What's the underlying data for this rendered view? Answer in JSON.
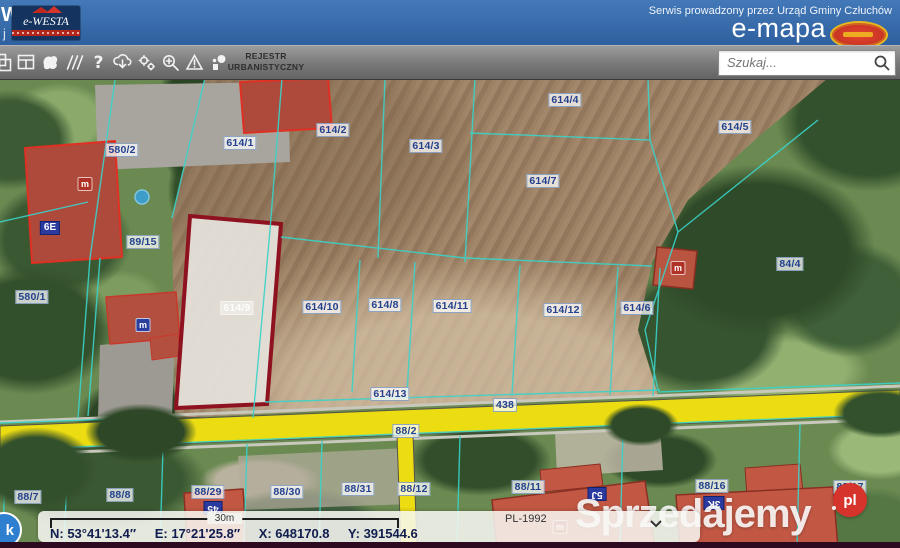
{
  "header": {
    "edge_text_top": "W",
    "edge_text_bottom": "j",
    "logo_ewesta": "e-WESTA",
    "service_text": "Serwis prowadzony przez Urząd Gminy Człuchów",
    "logo_emapa": "e-mapa"
  },
  "toolbar": {
    "register_label": "REJESTR URBANISTYCZNY",
    "search": {
      "placeholder": "Szukaj..."
    },
    "icons": [
      "windows-icon",
      "layout-panels-icon",
      "polygon-select-icon",
      "measure-icon",
      "help-icon",
      "cloud-download-icon",
      "settings-gears-icon",
      "zoom-search-icon",
      "warning-triangle-icon",
      "points-icon"
    ]
  },
  "map": {
    "highlighted_parcel": "614/9",
    "parcel_labels": [
      {
        "text": "580/2",
        "x": 122,
        "y": 150
      },
      {
        "text": "614/1",
        "x": 240,
        "y": 143
      },
      {
        "text": "614/2",
        "x": 333,
        "y": 130
      },
      {
        "text": "614/3",
        "x": 426,
        "y": 146
      },
      {
        "text": "614/4",
        "x": 565,
        "y": 100
      },
      {
        "text": "614/5",
        "x": 735,
        "y": 127
      },
      {
        "text": "614/7",
        "x": 543,
        "y": 181
      },
      {
        "text": "89/15",
        "x": 143,
        "y": 242
      },
      {
        "text": "84/4",
        "x": 790,
        "y": 264
      },
      {
        "text": "580/1",
        "x": 32,
        "y": 297
      },
      {
        "text": "614/9",
        "x": 237,
        "y": 308,
        "style": "faint"
      },
      {
        "text": "614/10",
        "x": 322,
        "y": 307
      },
      {
        "text": "614/8",
        "x": 385,
        "y": 305
      },
      {
        "text": "614/11",
        "x": 452,
        "y": 306
      },
      {
        "text": "614/12",
        "x": 563,
        "y": 310
      },
      {
        "text": "614/6",
        "x": 637,
        "y": 308
      },
      {
        "text": "614/13",
        "x": 390,
        "y": 394
      },
      {
        "text": "438",
        "x": 505,
        "y": 405
      },
      {
        "text": "88/2",
        "x": 406,
        "y": 431
      },
      {
        "text": "88/7",
        "x": 28,
        "y": 497
      },
      {
        "text": "88/8",
        "x": 120,
        "y": 495
      },
      {
        "text": "88/29",
        "x": 208,
        "y": 492
      },
      {
        "text": "88/30",
        "x": 287,
        "y": 492
      },
      {
        "text": "88/31",
        "x": 358,
        "y": 489
      },
      {
        "text": "88/12",
        "x": 414,
        "y": 489
      },
      {
        "text": "88/11",
        "x": 528,
        "y": 487
      },
      {
        "text": "88/16",
        "x": 712,
        "y": 486
      },
      {
        "text": "88/17",
        "x": 850,
        "y": 487
      }
    ],
    "house_numbers": [
      {
        "text": "6E",
        "x": 50,
        "y": 228,
        "rotate": 0
      },
      {
        "text": "45",
        "x": 213,
        "y": 508,
        "rotate": 180
      },
      {
        "text": "5J",
        "x": 597,
        "y": 494,
        "rotate": 180
      },
      {
        "text": "3K",
        "x": 714,
        "y": 503,
        "rotate": 180
      }
    ],
    "address_icons": [
      {
        "x": 85,
        "y": 184,
        "color": "#b03226"
      },
      {
        "x": 143,
        "y": 325,
        "color": "#2b3f9e"
      },
      {
        "x": 678,
        "y": 268,
        "color": "#b03226"
      },
      {
        "x": 560,
        "y": 527,
        "color": "#b03226"
      }
    ]
  },
  "statusbar": {
    "scale_label": "30m",
    "crs_label": "PL-1992",
    "coordinates": [
      "N: 53°41'13.4″",
      "E: 17°21'25.8″",
      "X: 648170.8",
      "Y: 391544.6"
    ],
    "corner_badge_text": "k"
  },
  "watermark": {
    "text": "Sprzedajemy",
    "suffix": "pl"
  },
  "colors": {
    "topbar_blue": "#3a70b2",
    "parcel_line_cyan": "#3ad3c9",
    "highlight_red": "#8e1220",
    "road_yellow": "#ecdc12",
    "label_blue": "#23418e"
  }
}
